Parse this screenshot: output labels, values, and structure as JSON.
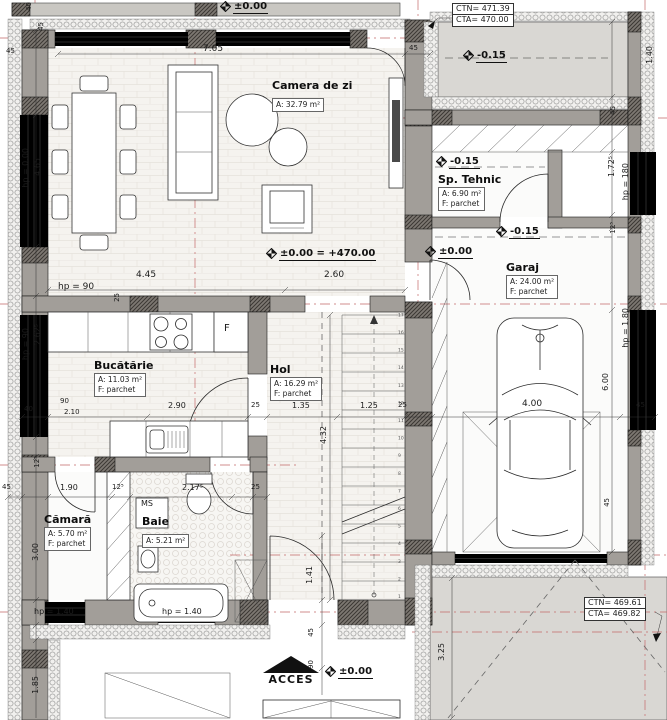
{
  "rooms": {
    "camera_de_zi": {
      "name": "Camera de zi",
      "area": "A: 32.79 m²"
    },
    "sp_tehnic": {
      "name": "Sp. Tehnic",
      "area": "A: 6.90 m²",
      "floor": "F: parchet"
    },
    "garaj": {
      "name": "Garaj",
      "area": "A: 24.00 m²",
      "floor": "F: parchet"
    },
    "bucatarie": {
      "name": "Bucătărie",
      "area": "A: 11.03 m²",
      "floor": "F: parchet"
    },
    "hol": {
      "name": "Hol",
      "area": "A: 16.29 m²",
      "floor": "F: parchet"
    },
    "camara": {
      "name": "Cămară",
      "area": "A: 5.70 m²",
      "floor": "F: parchet"
    },
    "baie": {
      "name": "Baie",
      "area": "A: 5.21 m²"
    }
  },
  "levels": {
    "top": "±0.00",
    "terrace": "-0.15",
    "sp_tehnic": "-0.15",
    "garage": "-0.15",
    "hol_door": "±0.00",
    "main": "±0.00 = +470.00",
    "entry": "±0.00"
  },
  "benchmarks": {
    "top": {
      "ctn": "CTN= 471.39",
      "cta": "CTA= 470.00"
    },
    "bottom": {
      "ctn": "CTN= 469.61",
      "cta": "CTA= 469.82"
    }
  },
  "labels": {
    "acces": "ACCES",
    "ms": "MS",
    "fridge": "F"
  },
  "stairs": {
    "step_count": 17
  },
  "dims": {
    "corner_40": "40",
    "corner_45": "45",
    "corner_45b": "45",
    "living_top": "7.05",
    "top_wall_45": "45",
    "living_left_hp": "hp = 0.00",
    "living_left_len": "4.65",
    "living_bottom_left": "4.45",
    "living_bottom_right": "2.60",
    "living_hp90": "hp = 90",
    "wall_25_left": "25",
    "kitchen_win_hp": "hp = 90",
    "kitchen_win_len": "2.62⁵",
    "k_40": "40",
    "k_90": "90",
    "k_210": "2.10",
    "k_290": "2.90",
    "k_25": "25",
    "hol_135": "1.35",
    "stair_w": "1.25",
    "stair_wall": "25",
    "stair_len": "4.32",
    "garage_w": "4.00",
    "garage_len": "6.00",
    "garage_45": "45",
    "cam_12_5_l": "12⁵",
    "cam_45": "45",
    "cam_190": "1.90",
    "cam_12_5": "12⁵",
    "baie_217_5": "2.17⁵",
    "baie_25": "25",
    "cam_300": "3.00",
    "yard_185": "1.85",
    "win_sw_hp": "hp = 1.40",
    "win_s_hp": "hp = 1.40",
    "entry_141": "1.41",
    "entry_45": "45",
    "entry_90": "90",
    "drive_325": "3.25",
    "terrace_140": "1.40",
    "r_45": "45",
    "r_172_5": "1.72⁵",
    "r_hp180": "hp = 180",
    "r_12_5": "12⁵",
    "r_hp180b": "hp = 1.80",
    "dr_45": "45"
  }
}
